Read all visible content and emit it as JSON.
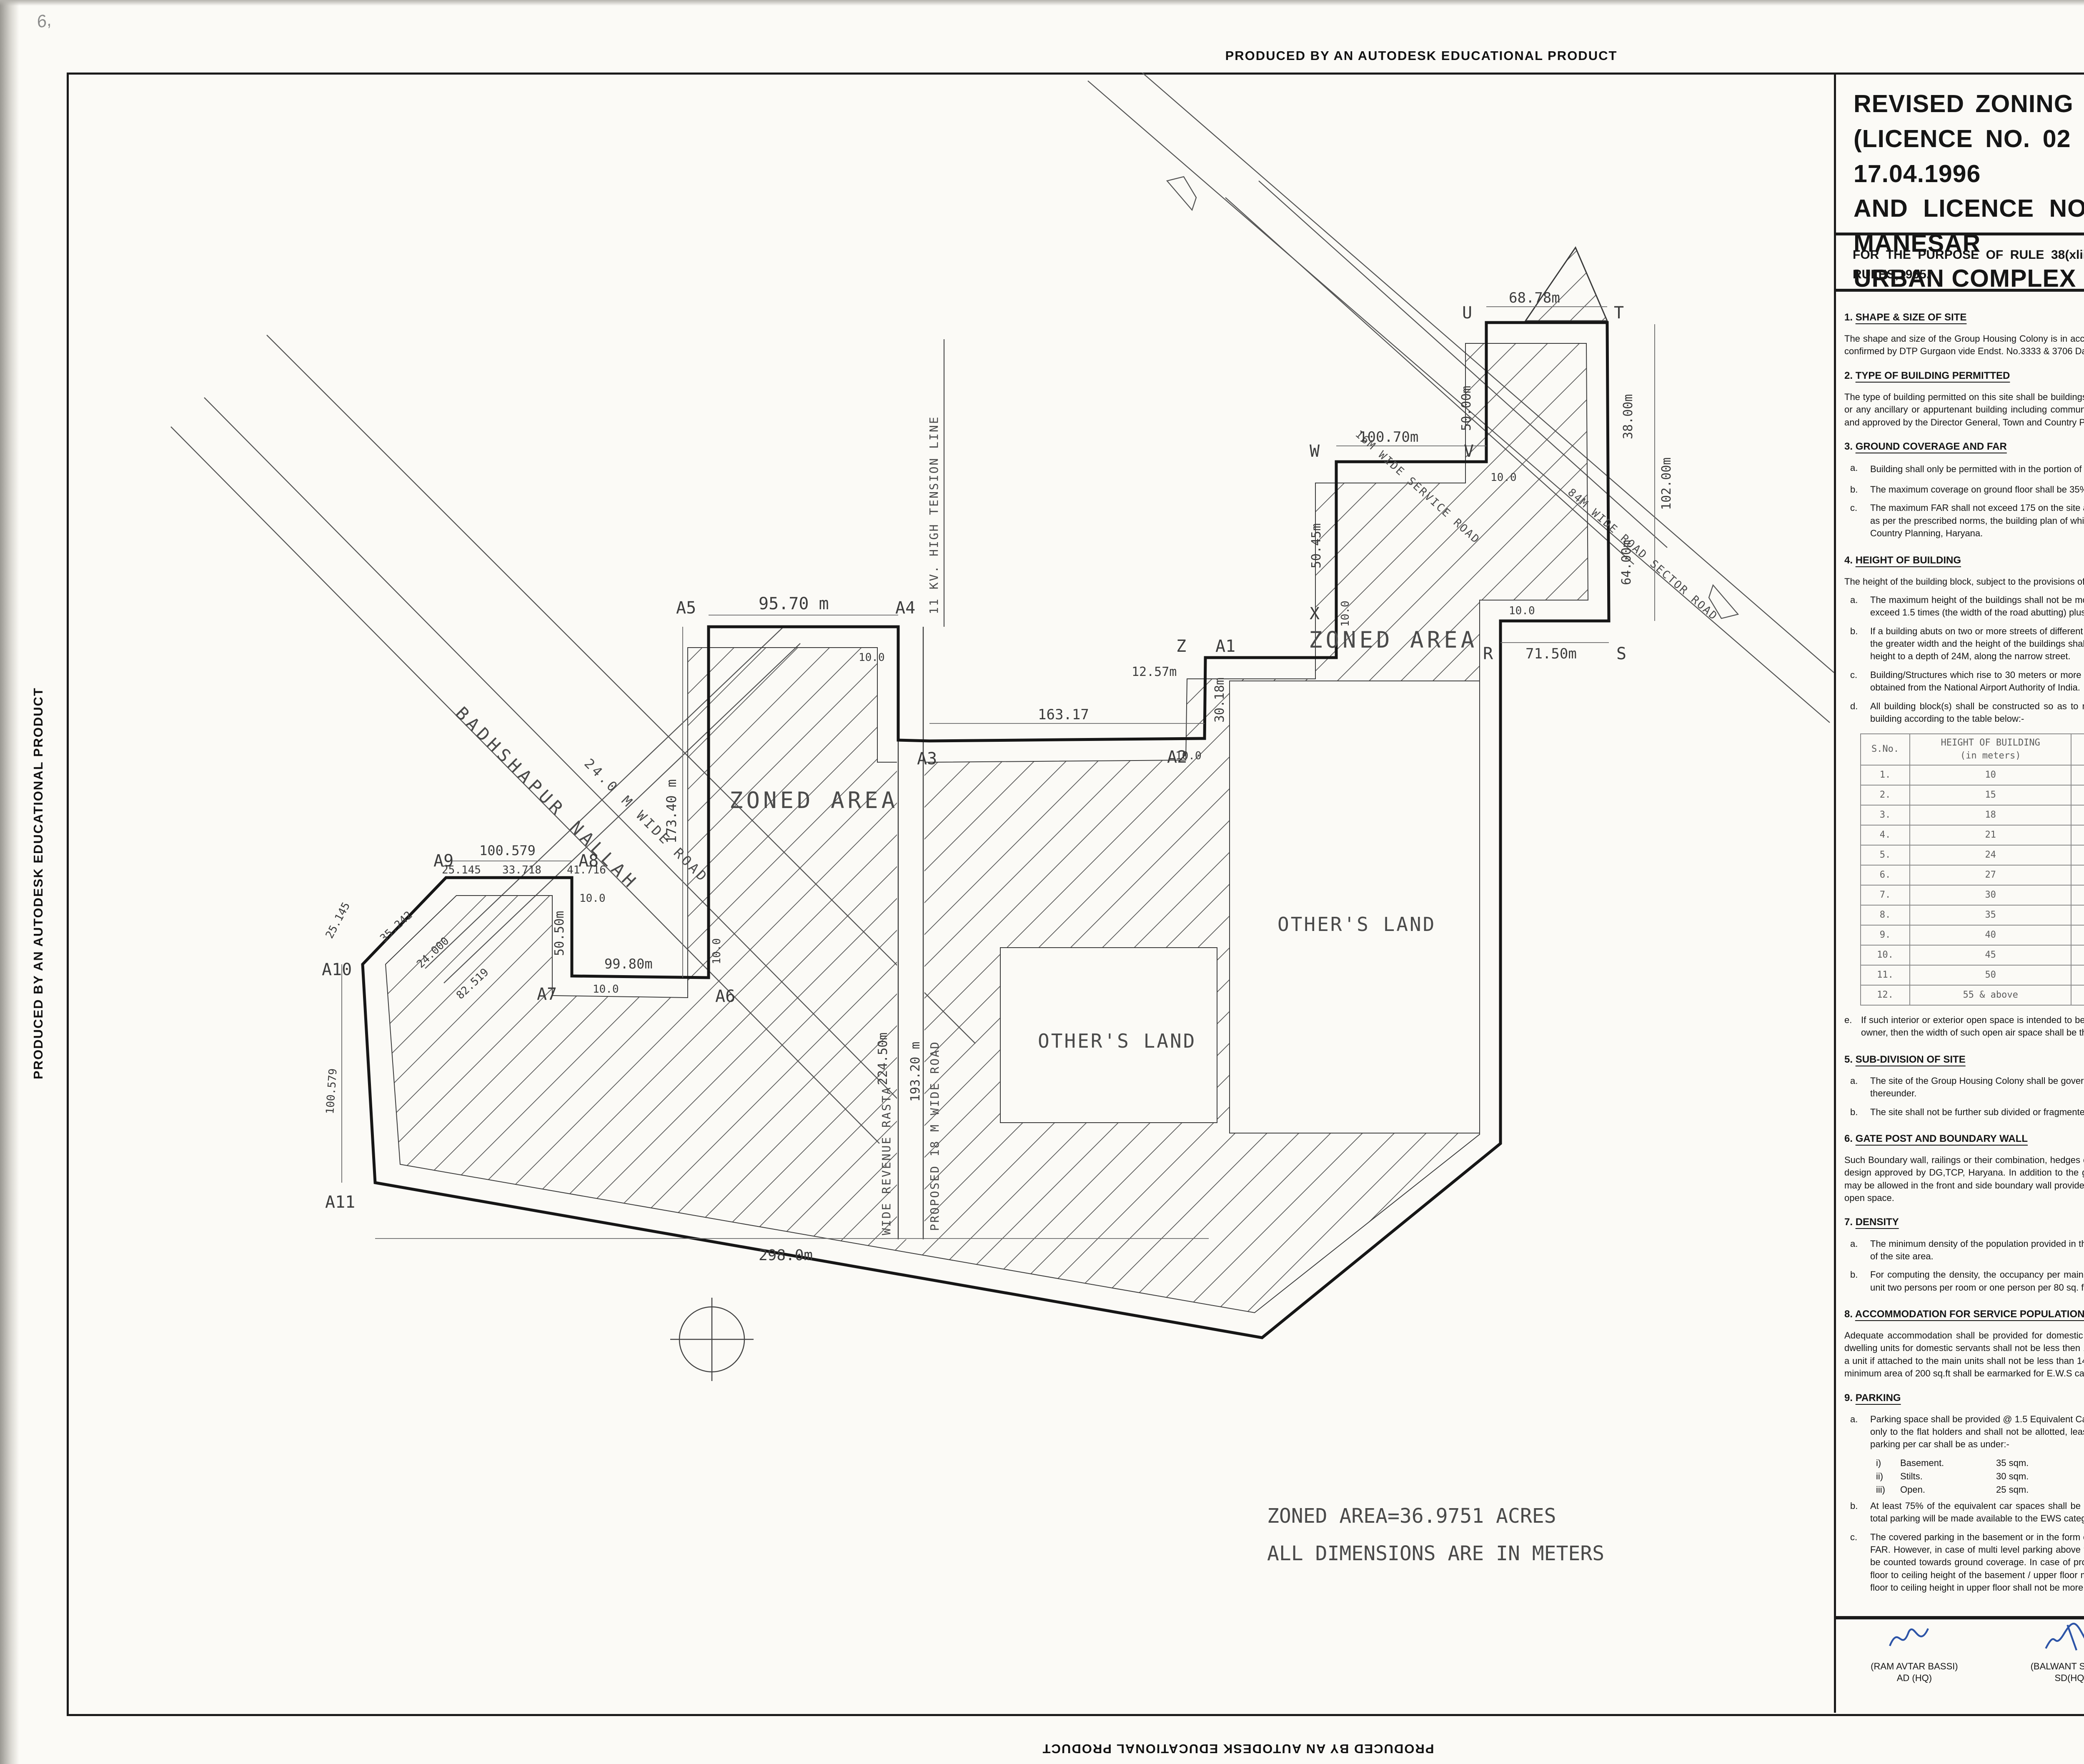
{
  "edge": {
    "text": "PRODUCED BY AN AUTODESK EDUCATIONAL PRODUCT"
  },
  "pencil": "6,",
  "title": {
    "l1": "REVISED ZONING PLAN OF GROUP HOUSING COLONY MEASURING 47.4180 ACRES",
    "l2": "(LICENCE NO. 02 OF 1995 DATED 10.03.1995 , LICENCE NO. 35-37 OF 1996 DATED 17.04.1996",
    "l3": "AND LICENCE NO. 117-119 OF 2004 DATED 16.08.2004) IN SECTOR48, GURGAON MANESAR",
    "l4": "URBAN COMPLEX  BEING DEVELOPED BY SWETA ESTATES PVT. LTD. AND OTHERS ."
  },
  "subtitle": {
    "l1": "FOR THE PURPOSE OF RULE 38(xlii) AND 48 (2) OF THE PUNJAB SCHEDULED ROADS  AND CONTROLLED AREAS RESTRICTION OF UNREGULATED DEVELOPMENT",
    "l2": "RULES,1965."
  },
  "notes_left": [
    {
      "no": "1.",
      "heading": "SHAPE & SIZE OF SITE",
      "paras": [
        "The shape and size of the Group Housing Colony is in accordance with the demarcation plan shown as  A to Z  and A1 to A14 as confirmed by DTP Gurgaon vide Endst. No.3333 & 3706 Dated 05.08.2014 & 23.08.2014."
      ]
    },
    {
      "no": "2.",
      "heading": "TYPE OF BUILDING PERMITTED",
      "paras": [
        "The type of building permitted on this site shall be buildings designated in the form of flatted development for residential purpose or any ancillary or appurtenant building  including community facilities, public amenities and public utility as may be prescribed and approved by the Director General, Town and Country Planning, Haryana."
      ]
    },
    {
      "no": "3.",
      "heading": "GROUND COVERAGE AND FAR",
      "a_label": "a.",
      "a_t1": "Building shall only be permitted with in the portion of the site marked as",
      "a_t2": "build able  zone and no where else.",
      "items": [
        {
          "l": "b.",
          "t": "The maximum coverage on ground floor shall be 35% and that on subsequent floors shall be 30% on the area of site area."
        },
        {
          "l": "c.",
          "t": "The maximum FAR shall not exceed 175 on the site area. However, it shall not include community buildings, which shall be as per the prescribed norms, the building plan of which shall  have to be got approved from the Director General, Town and Country Planning, Haryana."
        }
      ]
    },
    {
      "no": "4.",
      "heading": "HEIGHT OF BUILDING",
      "intro": "The height of the building block, subject to the provisions of the site coverage and FAR, shall be governed by the following:-",
      "items": [
        {
          "l": "a.",
          "t": "The maximum height of the buildings shall not be more than as allowed by National Airport Authority of India and shall not exceed 1.5 times (the width of the road abutting) plus the front  open space."
        },
        {
          "l": "b.",
          "t": "If a building abuts on two or more streets of different widths, the buildings shall be deemed to face upon the street that has the greater width and the height of the buildings shall be regulated by the width of that street and may be continued to this height to a depth of 24M, along the narrow street."
        },
        {
          "l": "c.",
          "t": "Building/Structures which rise to 30 meters or more in height shall be constructed only if no objection certificate has been obtained from the National Airport Authority of India."
        },
        {
          "l": "d.",
          "t": "All building block(s) shall be constructed so as to maintain an interse distance not less the set back required for each building according to the table below:-"
        }
      ],
      "e_label": "e.",
      "e_text": "If such interior or exterior open space is intended to be used for the benefit of more than one building belonging to the same owner, then the width of such open air space  shall be the one specified for the tallest building as specified above."
    },
    {
      "no": "5.",
      "heading": "SUB-DIVISION OF SITE",
      "items": [
        {
          "l": "a.",
          "t": "The site of the Group Housing Colony shall be governed by the Haryana Apartment  Ownership Act-1983  and Rules framed thereunder."
        },
        {
          "l": "b.",
          "t": "The site shall not be further sub divided or fragmented in any manner whatsoever."
        }
      ]
    },
    {
      "no": "6.",
      "heading": "GATE POST AND BOUNDARY WALL",
      "paras": [
        "Such Boundary wall, railings or their combination, hedges or fences along with gates  and gate posts shall be constructed as per design approved by DG,TCP, Haryana. In addition to the gate/gates an additional wicket gate not exceeding 1.25 meters width may be allowed in the front and side boundary wall provided that no main gate shall be allowed to open on the sector road/public open space."
      ]
    },
    {
      "no": "7.",
      "heading": "DENSITY",
      "items": [
        {
          "l": "a.",
          "t": "The minimum density of the population provided in the colony shall be 100 PPA and the maximum be 300 PPA on the area of the site area."
        },
        {
          "l": "b.",
          "t": "For computing the density, the occupancy per main dwelling unit shall be taken as five persons and for service dwelling unit two persons per room or one person per 80 sq. feet  of living area, whichever is more."
        }
      ]
    },
    {
      "no": "8.",
      "heading": "ACCOMMODATION FOR SERVICE POPULATION",
      "paras": [
        "Adequate accommodation shall be provided for domestic servants and other service  population of EWS.The number of such dwelling units for domestic servants shall not be less then 10% of the number of main dwelling units and the carpet area of such a unit if attached to the main units shall not be less than 140 sq.ft. In addition 15% of  the total number of dwelling units having a minimum area of 200 sq.ft shall be earmarked for E.W.S category."
      ]
    },
    {
      "no": "9.",
      "heading": "PARKING",
      "items": [
        {
          "l": "a.",
          "t": "Parking space shall be provided @ 1.5 Equivalent Car Space for each dwelling unit. These parking spaces shall be allotted only to the flat holders and shall not be  allotted, leased, sold or transferred in any manner to the third party. The area for  parking per car shall be as under:-"
        }
      ],
      "subs": [
        {
          "l": "i)",
          "n": "Basement.",
          "v": "35 sqm."
        },
        {
          "l": "ii)",
          "n": "Stilts.",
          "v": "30 sqm."
        },
        {
          "l": "iii)",
          "n": "Open.",
          "v": "25 sqm."
        }
      ],
      "items2": [
        {
          "l": "b.",
          "t": "At least 75% of the equivalent car spaces shall be provided in the form of covered parking. Further minimum 5% of the total parking will be made available to the EWS category flats."
        },
        {
          "l": "c.",
          "t": "The covered parking in the basement or in the form of multi level parking above ground level shall not be counted towards FAR. However, in case of multi level parking above the ground level the foot print of separate parking building block shall be counted towards ground coverage. In case of provision of mechanical parking in the basement floor/upper stories, the floor to ceiling height of the basement / upper floor may be maximum of 4.5 meter. Other than the mechanical parking the floor to ceiling height in upper floor shall not be more than 2.4 mtr. below the hanging beam."
        }
      ]
    }
  ],
  "table": {
    "h1": "S.No.",
    "h2a": "HEIGHT OF BUILDING",
    "h2b": "(in meters)",
    "h3a": "SET BACK / OPEN SPACE TO BE LEFT",
    "h3b": "AROUND BUILDINGS.(in meters)",
    "rows": [
      [
        "1.",
        "10",
        "3"
      ],
      [
        "2.",
        "15",
        "5"
      ],
      [
        "3.",
        "18",
        "6"
      ],
      [
        "4.",
        "21",
        "7"
      ],
      [
        "5.",
        "24",
        "8"
      ],
      [
        "6.",
        "27",
        "9"
      ],
      [
        "7.",
        "30",
        "10"
      ],
      [
        "8.",
        "35",
        "11"
      ],
      [
        "9.",
        "40",
        "12"
      ],
      [
        "10.",
        "45",
        "13"
      ],
      [
        "11.",
        "50",
        "14"
      ],
      [
        "12.",
        "55 & above",
        "16"
      ]
    ]
  },
  "notes_right": [
    {
      "no": "10.",
      "heading": "LIFTS AND RAMPS",
      "items": [
        {
          "l": "i.",
          "t": "In building having more than four storeys, lift with 100% standby generators alongwith automatic switchover is mandatory alongwith staircase of requisite width and number. At least one lift  with minimum size of 1.80 M X 3.00 M shall be provided."
        },
        {
          "l": "ii.",
          "t": "In building upto four storeys, if lifts with 100% standby generators  along with automatic switchover are not provided then ramps conforming to the requirement of clause D-3 of Annexure-D of Part 3 of National building Code-2005 shall be provided."
        }
      ]
    },
    {
      "no": "11.",
      "heading": "OPEN SPACES",
      "paras": [
        "While all the open spaces including those between the blocks and wings of buildings shall be developed, equipped and landscaped  according to the plan approved by the DG,TCP, Haryana. At least 15% of the total site area shall be developed as organized open space i.e tot lots and play ground."
      ]
    },
    {
      "no": "12.",
      "heading": "APPROVAL OF BUILDING PLANS",
      "paras": [
        "The building plans of the buildings to be constructed at site shall have to be got approved from the DG,TCP, Haryana under section 8(2) of the Punjab Scheduled Roads Controlled Areas, Restriction of Unregulated Development Act No.41 of 1963, before starting the construction."
      ]
    },
    {
      "no": "13.",
      "heading": "BUILDING BYE-LAWS",
      "paras": [
        "The construction of the building/buildings shall be governed by the building rules provided in part VII of the Punjab Scheduled Roads Controlled Areas, Restriction of Unregulated Development Rules, 1965 and Indian Standard Code No. 4963- 1987 regarding provisions for Physically Handicapped Persons. The owner shall also follow the provisions of Section 46 of The Persons With Disabilities (Equal Opportunities, Protection of Rights and Full Participation) Act, 1995 which includes construction of ramps in public buildings, adaption of toilets for wheel chair user, Braille symbols and auditory signals in elevators or lifts and other relevant measures. On the points where such rules are silent and stipulate no condition or norm, the model building byelaw issued by the Indian Standard, and as given in the National Building Code of India shall be followed as may be approved by DG,TCP, Haryana."
      ]
    },
    {
      "no": "14.",
      "heading": "CONVENIENT SHOPPING",
      "intro": "0.5% of the area of the site area shall be reserved to cater for essential convenient shopping with the following conditions.",
      "items": [
        {
          "l": "a.",
          "t": "The ground coverage of 100% with FAR of 100 will be permissible. However this will be a part of the permissible ground coverage and FAR of the Group Housing Colony."
        },
        {
          "l": "b.",
          "t": "The size of Kiosk/Shops shall not be more than 2.75 meter x 2.75 meter and 2.75 meter x 8.25 meter."
        },
        {
          "l": "c.",
          "t": "The height of Kiosk/Shops/Departmental Store shall not exceed 4.00 meter."
        }
      ]
    },
    {
      "no": "15.",
      "heading": "PROVISION OF COMMUNITY BUILDINGS",
      "paras": [
        "The community buildings shall be provided as per the composite norms in the Group  Housing Colony."
      ]
    },
    {
      "no": "16.",
      "heading": "BASEMENT",
      "items": [
        {
          "l": "a.",
          "t": "Four level basements within the building zone of the site, provided, it is flushes with the  ground and is properly landscaped, may be allowed. The basement in addition to parking could be utilized for generator room, lift room, fire fighting pumps, water reservoir, electric sub-station, air-conditioning plants and toilets/ utilities, if they satisfy the public health requirements and for no other purposes. Area under stilts (only for parking) and basement shall not be counted towards FAR. Basement shall not be used for storage/commercial purposes but will be used only for Parking. It is further stipulated that no other partitions of basement will be permissible for uses other than specified above."
        },
        {
          "l": "b.",
          "t": "The clear width of the ramp leading to the basement shall be 4.00 meters with an adequate slope not steeper than 1:10. The entry and exit of the ramp in basement shall be separate preferably at opposite ends"
        }
      ]
    },
    {
      "no": "17.",
      "heading": "APPROACH TO SITE",
      "paras": [
        "The vehicular approach to the site and parking lots shall be planned and provided giving due consideration to the junctions of and the junctions with the surrounding roads to the satisfaction of the DG,TCP, Haryana."
      ]
    },
    {
      "no": "18.",
      "heading": "FIRE SAFETY MEASURES",
      "items": [
        {
          "l": "a.",
          "t": "The owner will ensure the provision of proper fire safety measures in the multi storey buildings conforming to the provisions of Punjab Scheduled Roads Controlled Areas, Restriction of Unregulated Development Rules, 1965/ National Building Code of India and the same should be got certified from the competent authority."
        },
        {
          "l": "b.",
          "t": "Electric Sub Station / generator room if provided should be on solid ground near  DG/LT. Control panel on ground floor or in upper basement and it should be located on outer periphery of the building, the same should be got approved from the competent authority."
        },
        {
          "l": "c.",
          "t": "To ensure  the Fire Fighting Scheme shall be got approved from the Director. Urban Local Bodies, Haryana or any person authorized by the Director,Urban Local bodies, Haryana. These approvals shall be obtained prior to starting the construction work at site."
        }
      ]
    },
    {
      "no": "19.",
      "heading": "SOLAR WATER HEATING SYSTEM",
      "paras": [
        "The provision of solar water heating system shall be as per norms specified by HAREDA and shall be made operational in each building block before applying for an occupation certificate."
      ]
    },
    {
      "no": "20.",
      "heading": "RAIN WATER HARVESTING SYSTEM",
      "paras": [
        "The rain water harvesting system shall be provided as per Central Ground Water Authority norms/Haryana Govt.  notification as applicable."
      ]
    },
    {
      "no": "21.",
      "text": "The colonizer shall obtain the clearance/NOC as per the provisions of the Notification No. S.O. 1533(E) Dated 14.9.2006 issued by Ministry of Environment and Forest, Government of India before starting the construction/ execution of development works at site."
    },
    {
      "no": "22.",
      "text": "The coloniser/owner shall use only Compact Fluorescent Lamps fittings for internal lighting as well as campus lighting."
    },
    {
      "no": "23.",
      "text": "That no separate zoning plan is approved for community sites earmarked within a Group Housing Colony. The community building/buildings shall be constructed by the coloniser/owner as per provision of The Haryana Development and Regulation of Urban Areas (Amendment and Validation) Act No. 4 of 2012, failing which the said site shall vest with the Govt."
    },
    {
      "no": "24.",
      "text": "That you shall abide by the policies issued by the Department  time to time regarding allotment of EWS flats ."
    },
    {
      "no": "25.",
      "text": "The coloniser shall convey the \"Ultimate Power Load Requirement\" of the project to the concerned power utility, with a copy to the Director, within two months period from the date of grant of licence to enable provision of site in your land for Transformers/Switching Station/Electric Sub-Stations as  per the norms prescribed by the power utility at the time of approval of building plans of the project."
    }
  ],
  "drg": {
    "label": "DRG. NO. DG,TCP",
    "no": "5151",
    "dated_label": "DATED:-",
    "date": "01-05-2015"
  },
  "signatures": [
    {
      "name": "(RAM AVTAR BASSI)",
      "title": "AD (HQ)"
    },
    {
      "name": "(BALWANT SINGH)",
      "title": "SD(HQ)"
    },
    {
      "name": "(RAJESH KAUSHIK)",
      "title": "ATP (HQ)"
    },
    {
      "name": "(P.P. SINGH)",
      "title": "DTP (HQ)"
    },
    {
      "name": "(JASWANT SINGH)",
      "title": "STP(M) HQ"
    },
    {
      "name": "(DILBAG SINGH SIHAG)",
      "title": "CTP (HR)"
    },
    {
      "name": "(ARUN KUMAR GUPTA, IAS)",
      "title": "DG,TCP (HR)"
    }
  ],
  "plan": {
    "zoned_area": "ZONED AREA",
    "others_land": "OTHER'S LAND",
    "nallah": "BADHSHAPUR  NALLAH",
    "road24": "24.0 M WIDE ROAD",
    "sector_road": "84M WIDE ROAD SECTOR ROAD",
    "service_road": "16M WIDE SERVICE ROAD",
    "ht_line": "11 KV. HIGH TENSION LINE",
    "proposed_road": "PROPOSED 18 M WIDE ROAD",
    "revenue_rasta": "WIDE REVENUE RASTA",
    "setback": "10.0",
    "area_note1": "ZONED AREA=36.9751 ACRES",
    "area_note2": "ALL DIMENSIONS ARE IN METERS",
    "dims": {
      "d9570": "95.70 m",
      "d17340": "173.40 m",
      "d9980": "99.80m",
      "d5050": "50.50m",
      "d100579": "100.579",
      "d25145": "25.145",
      "d33718": "33.718",
      "d41716": "41.716",
      "d35242": "35.242",
      "d24000": "24.000",
      "d82519": "82.519",
      "d298": "298.0m",
      "d163": "163.17",
      "d3018": "30.18m",
      "d1257": "12.57m",
      "d10070": "100.70m",
      "d5045": "50.45m",
      "d5000": "50.00m",
      "d6878": "68.78m",
      "d3800": "38.00m",
      "d6400": "64.00m",
      "d10200": "102.00m",
      "d7150": "71.50m",
      "d22450": "224.50m",
      "d19320": "193.20 m"
    },
    "points": {
      "a1": "A1",
      "a2": "A2",
      "a3": "A3",
      "a4": "A4",
      "a5": "A5",
      "a6": "A6",
      "a7": "A7",
      "a8": "A8",
      "a9": "A9",
      "a10": "A10",
      "a11": "A11",
      "r": "R",
      "s": "S",
      "t": "T",
      "u": "U",
      "v": "V",
      "w": "W",
      "x": "X",
      "z": "Z"
    }
  }
}
